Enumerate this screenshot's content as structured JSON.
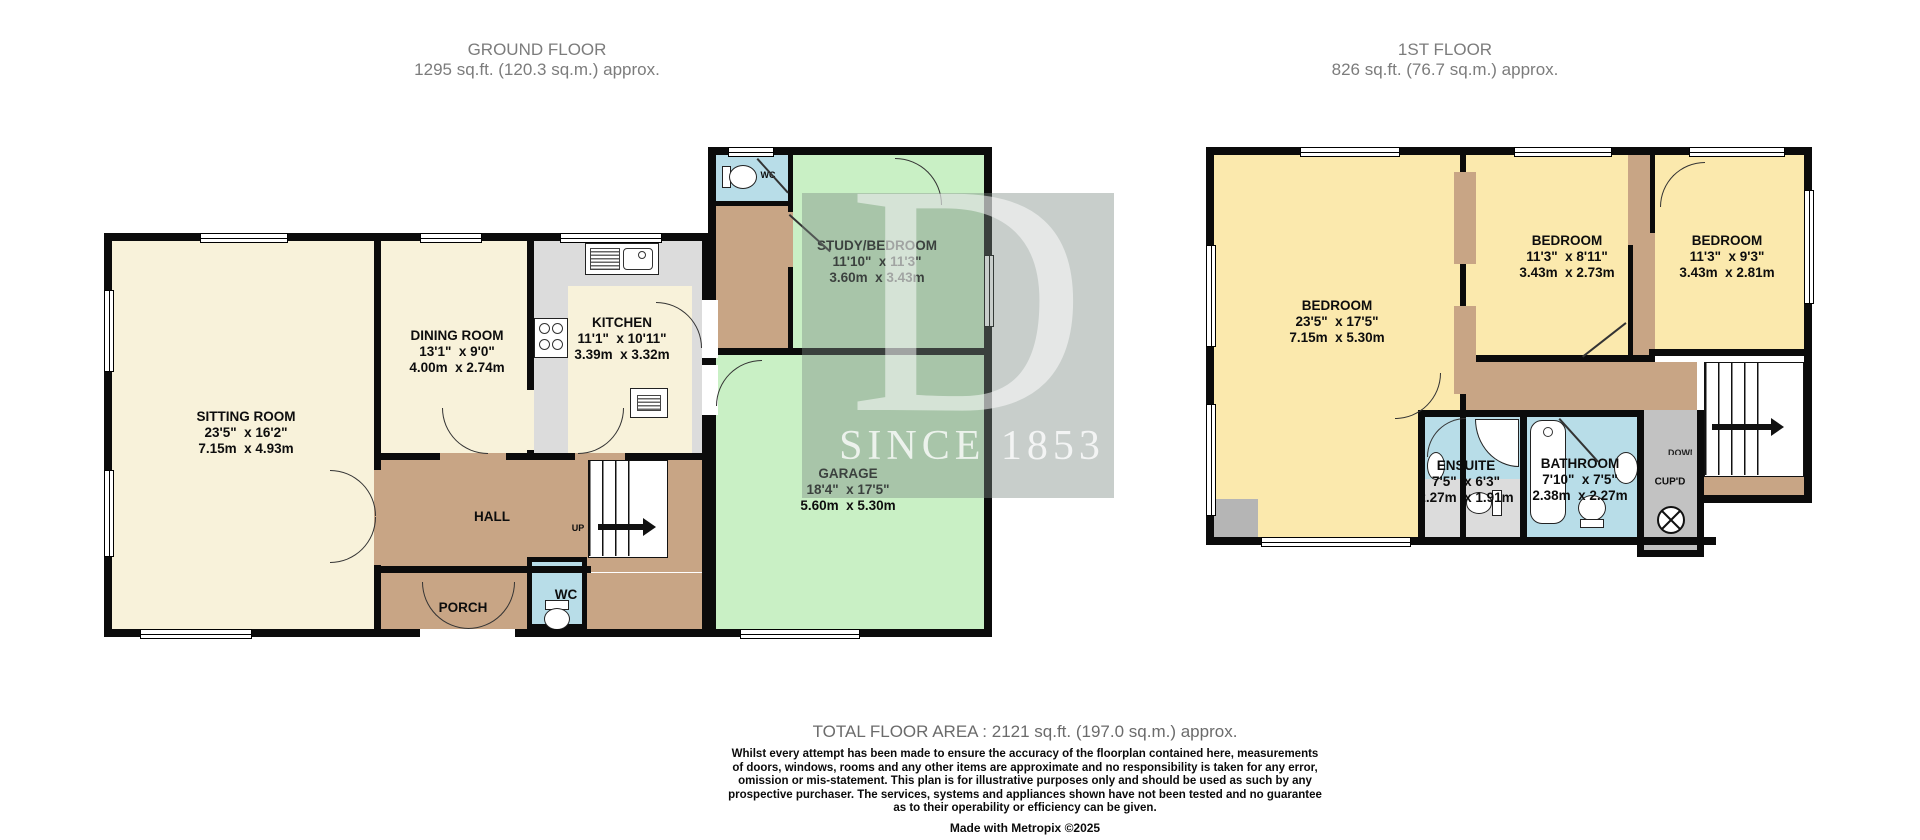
{
  "floors": {
    "ground": {
      "title": "GROUND FLOOR",
      "subtitle": "1295 sq.ft. (120.3 sq.m.) approx."
    },
    "first": {
      "title": "1ST FLOOR",
      "subtitle": "826 sq.ft. (76.7 sq.m.) approx."
    }
  },
  "rooms": {
    "sitting": {
      "name": "SITTING ROOM",
      "imperial": "23'5\"  x 16'2\"",
      "metric": "7.15m  x 4.93m"
    },
    "dining": {
      "name": "DINING ROOM",
      "imperial": "13'1\"  x 9'0\"",
      "metric": "4.00m  x 2.74m"
    },
    "kitchen": {
      "name": "KITCHEN",
      "imperial": "11'1\"  x 10'11\"",
      "metric": "3.39m  x 3.32m"
    },
    "study": {
      "name": "STUDY/BEDROOM",
      "imperial": "11'10\"  x 11'3\"",
      "metric": "3.60m  x 3.43m"
    },
    "garage": {
      "name": "GARAGE",
      "imperial": "18'4\"  x 17'5\"",
      "metric": "5.60m  x 5.30m"
    },
    "hall": {
      "name": "HALL"
    },
    "porch": {
      "name": "PORCH"
    },
    "wc_ground": {
      "name": "WC"
    },
    "wc_garage": {
      "name": "WC"
    },
    "bedroom1": {
      "name": "BEDROOM",
      "imperial": "23'5\"  x 17'5\"",
      "metric": "7.15m  x 5.30m"
    },
    "bedroom2": {
      "name": "BEDROOM",
      "imperial": "11'3\"  x 8'11\"",
      "metric": "3.43m  x 2.73m"
    },
    "bedroom3": {
      "name": "BEDROOM",
      "imperial": "11'3\"  x 9'3\"",
      "metric": "3.43m  x 2.81m"
    },
    "ensuite": {
      "name": "ENSUITE",
      "imperial": "7'5\"  x 6'3\"",
      "metric": "2.27m  x 1.91m"
    },
    "bathroom": {
      "name": "BATHROOM",
      "imperial": "7'10\"  x 7'5\"",
      "metric": "2.38m  x 2.27m"
    },
    "cupboard": {
      "name": "CUP'D"
    }
  },
  "stairs": {
    "up_label": "UP",
    "down_label": "DOWN"
  },
  "watermark": {
    "letter": "D",
    "caption": "SINCE 1853"
  },
  "footer": {
    "total": "TOTAL FLOOR AREA : 2121 sq.ft. (197.0 sq.m.) approx.",
    "disclaimer": "Whilst every attempt has been made to ensure the accuracy of the floorplan contained here, measurements\nof doors, windows, rooms and any other items are approximate and no responsibility is taken for any error,\nomission or mis-statement. This plan is for illustrative purposes only and should be used as such by any\nprospective purchaser. The services, systems and appliances shown have not been tested and no guarantee\nas to their operability or efficiency can be given.",
    "credit": "Made with Metropix ©2025"
  },
  "colors": {
    "wall": "#0b0b0b",
    "cream_room": "#f8f2da",
    "yellow_room": "#fbe9ad",
    "tan_hall": "#c8a585",
    "blue_wet_room": "#b8dde8",
    "green_garage": "#c9f0c5",
    "gray_floor": "#dcdcdc",
    "gray_cupboard": "#c2c2c2",
    "title_gray": "#7c7c7c",
    "watermark_overlay": "rgba(125,138,132,0.42)"
  }
}
